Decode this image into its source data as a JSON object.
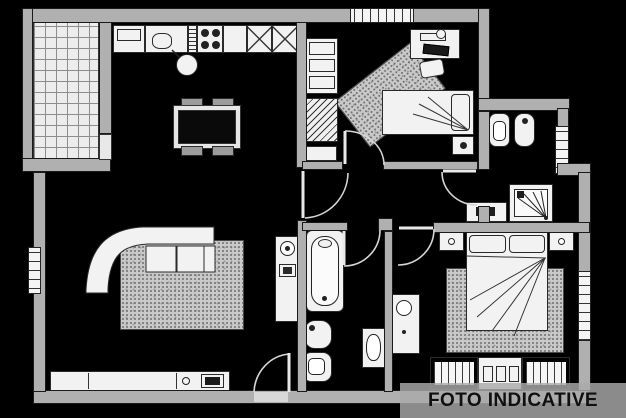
{
  "overlay": {
    "label": "FOTO INDICATIVE"
  },
  "palette": {
    "background": "#000000",
    "wall": "#b0b0b0",
    "line": "#1a1a1a",
    "fixture": "#f2f2f2",
    "rug": "#c9c9c9",
    "tile": "#ededed",
    "overlay_band": "rgba(170,170,170,0.82)",
    "overlay_text": "#101010"
  },
  "plan": {
    "type": "apartment-floor-plan",
    "rooms": [
      "balcony-terrace",
      "kitchen-living-room",
      "bedroom-small",
      "hallway",
      "bathroom-main",
      "bathroom-ensuite",
      "dressing-corridor",
      "bedroom-master"
    ],
    "fixtures": [
      "kitchen-counter",
      "sink",
      "hob",
      "tall-cabinets",
      "dining-table",
      "chairs",
      "corner-sofa",
      "area-rug",
      "tv-sideboard",
      "laundry-column",
      "bathtub",
      "bidet",
      "toilet",
      "washbasin",
      "shower",
      "single-bed",
      "desk",
      "desk-chair",
      "radiator",
      "shelf-unit",
      "double-bed",
      "nightstands",
      "wardrobe",
      "dresser",
      "boiler-cabinet"
    ],
    "windows": 4,
    "doors": 7
  }
}
